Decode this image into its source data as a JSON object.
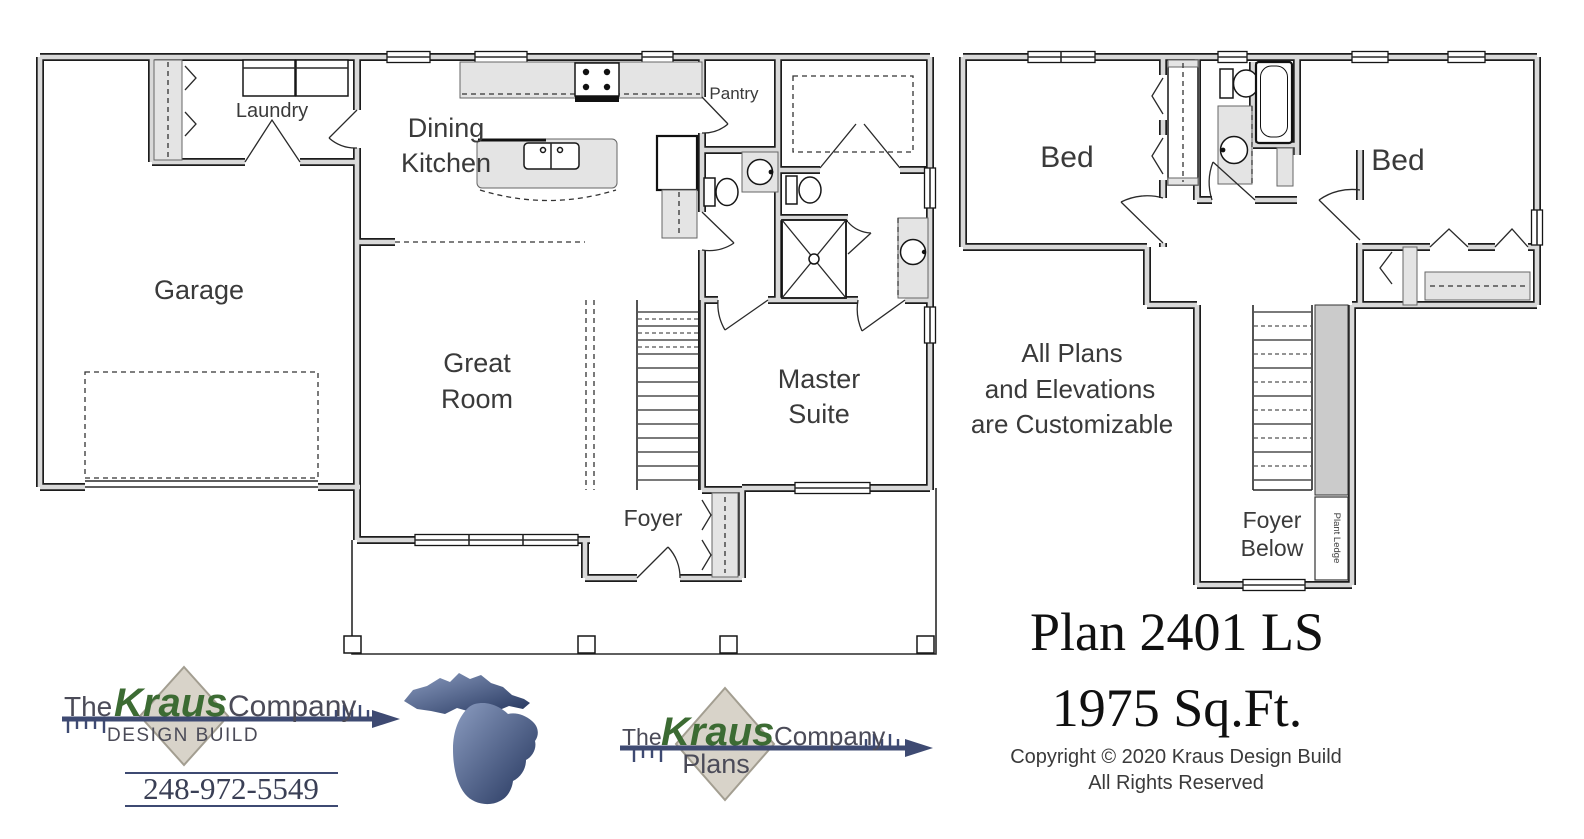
{
  "ff": {
    "garage": "Garage",
    "laundry": "Laundry",
    "dining1": "Dining",
    "dining2": "Kitchen",
    "pantry": "Pantry",
    "great1": "Great",
    "great2": "Room",
    "master1": "Master",
    "master2": "Suite",
    "foyer": "Foyer"
  },
  "sf": {
    "bed_left": "Bed",
    "bed_right": "Bed",
    "note1": "All Plans",
    "note2": "and Elevations",
    "note3": "are Customizable",
    "foyer_below1": "Foyer",
    "foyer_below2": "Below",
    "plant_ledge": "Plant Ledge"
  },
  "plan_info": {
    "title": "Plan 2401 LS",
    "area": "1975 Sq.Ft.",
    "copyright1": "Copyright © 2020 Kraus Design Build",
    "copyright2": "All Rights Reserved"
  },
  "branding": {
    "design_build_logo": {
      "prefix": "The",
      "name": "Kraus",
      "suffix": "Company",
      "tagline": "DESIGN BUILD",
      "phone": "248-972-5549"
    },
    "plans_logo": {
      "prefix": "The",
      "name": "Kraus",
      "suffix": "Company",
      "tagline": "Plans"
    },
    "michigan_icon": "michigan-state-silhouette"
  },
  "colors": {
    "wall_fill": "#d9d9d9",
    "kraus_green": "#3c6b33",
    "arrow_navy": "#3e4a72",
    "diamond_fill": "#d8d3c9",
    "michigan_light": "#8093b8",
    "michigan_dark": "#24355e"
  }
}
